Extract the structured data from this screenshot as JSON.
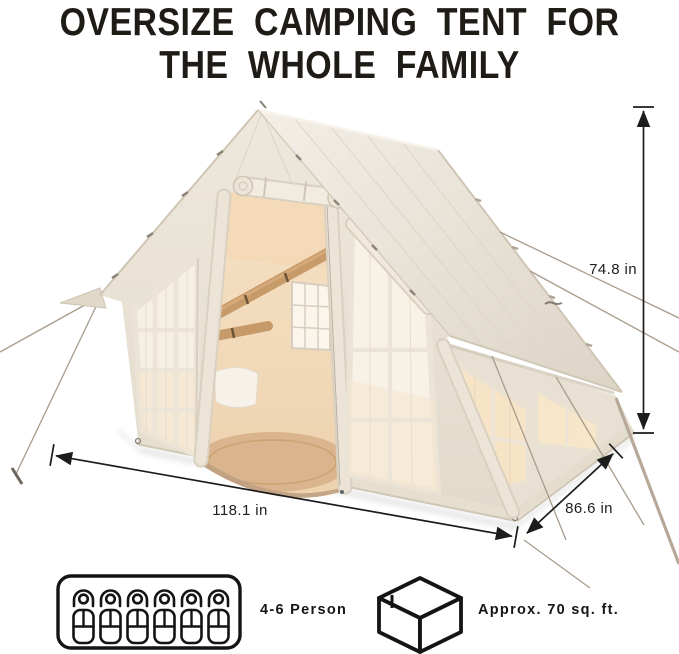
{
  "title": {
    "line1": "OVERSIZE CAMPING TENT FOR",
    "line2": "THE WHOLE FAMILY"
  },
  "dimensions": {
    "height_label": "74.8 in",
    "width_label": "118.1 in",
    "depth_label": "86.6 in"
  },
  "features": {
    "capacity": {
      "icon": "sleeping-capacity-icon",
      "label": "4-6 Person"
    },
    "area": {
      "icon": "storage-box-icon",
      "label": "Approx. 70 sq. ft."
    }
  },
  "illustration": {
    "icons": [
      "tent-illustration",
      "sleeping-capacity-icon",
      "storage-box-icon"
    ]
  },
  "colors": {
    "canvas": "#ece6da",
    "canvas_shade": "#ded6c8",
    "interior_wall": "#f4dcbe",
    "beam": "#c79a6a",
    "floor": "#d9b48c",
    "window_glow": "#f7e3c6",
    "annotation": "#1c1c1c"
  }
}
